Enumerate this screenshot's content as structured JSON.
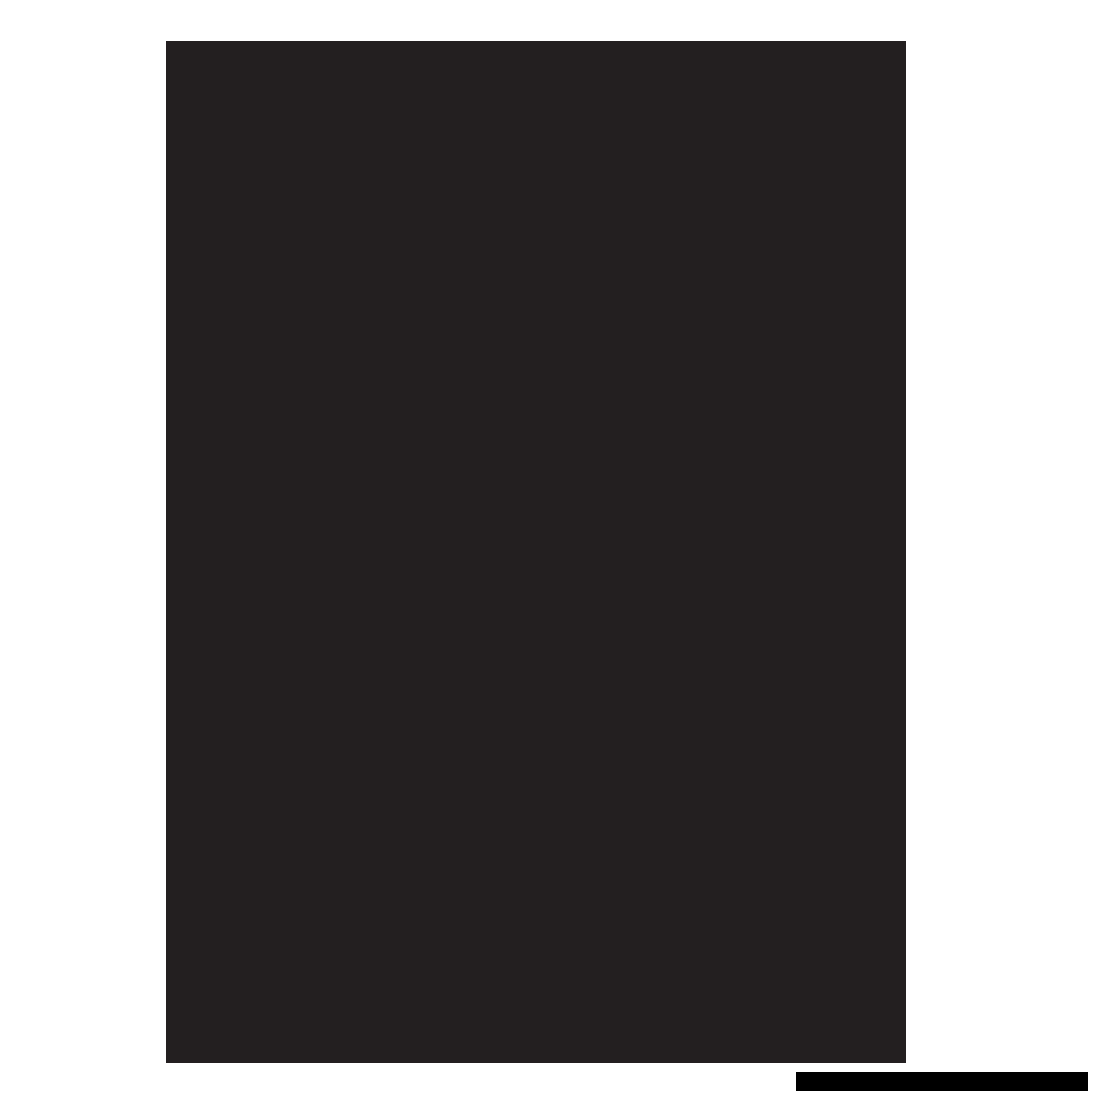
{
  "colors": {
    "canvas_background": "#FFFFFF",
    "document_page": "#231F20",
    "bottom_bar": "#000000"
  }
}
